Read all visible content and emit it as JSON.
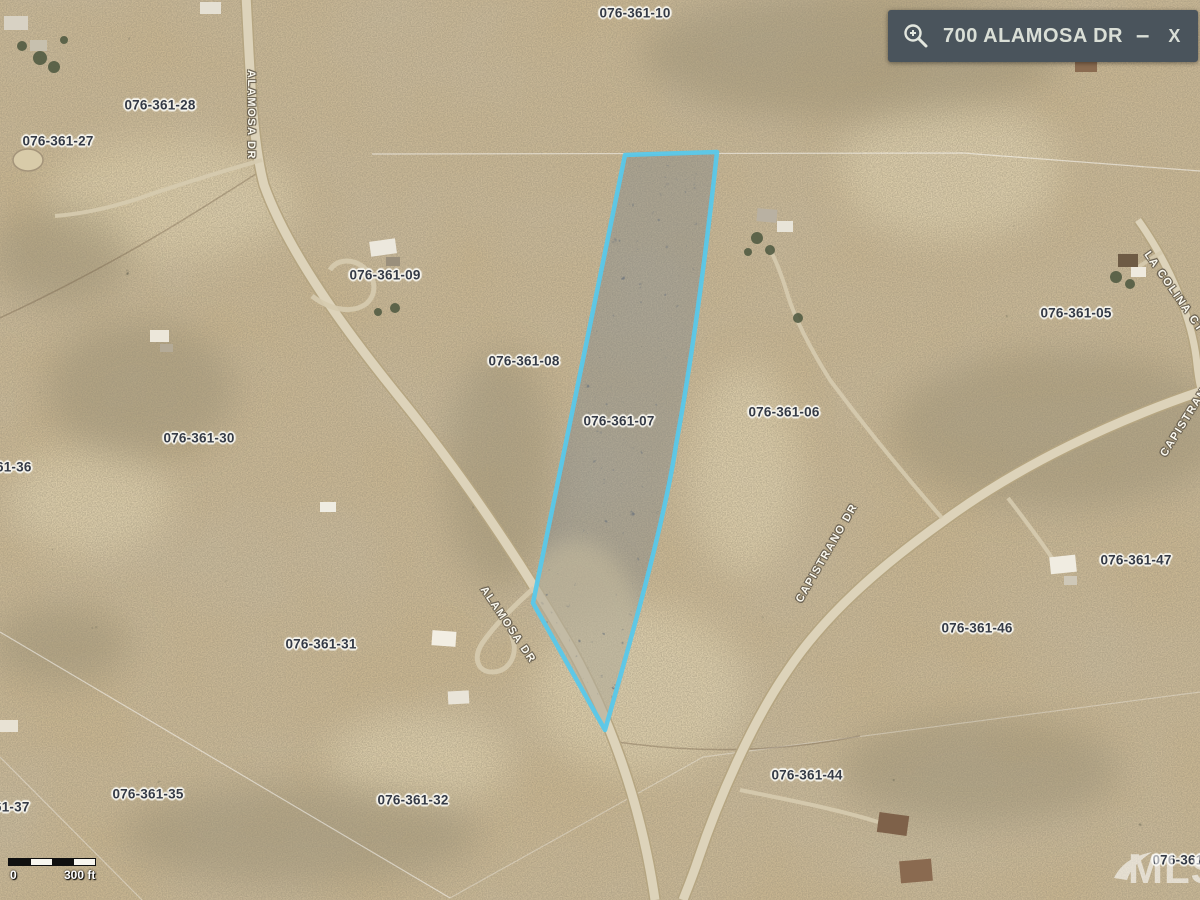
{
  "colors": {
    "highlight_stroke": "#58c8ea",
    "highlight_fill": "#6f7d8a",
    "panel_bg": "#4a545c",
    "panel_text": "#dadfd7",
    "terrain_base": "#c9b691",
    "parcel_label_text": "#343a46",
    "street_label_text": "#fbf9f0"
  },
  "search_panel": {
    "query": "700 ALAMOSA DR",
    "minimize_label": "–",
    "close_label": "X",
    "icon": "zoom-in-icon"
  },
  "map": {
    "highlighted_parcel": "076-361-07",
    "parcel_labels": [
      {
        "text": "076-361-10",
        "x": 635,
        "y": 13
      },
      {
        "text": "076-361-28",
        "x": 160,
        "y": 105
      },
      {
        "text": "076-361-27",
        "x": 58,
        "y": 141
      },
      {
        "text": "076-361-09",
        "x": 385,
        "y": 275
      },
      {
        "text": "076-361-08",
        "x": 524,
        "y": 361
      },
      {
        "text": "076-361-07",
        "x": 619,
        "y": 421
      },
      {
        "text": "076-361-06",
        "x": 784,
        "y": 412
      },
      {
        "text": "076-361-05",
        "x": 1076,
        "y": 313
      },
      {
        "text": "076-361-30",
        "x": 199,
        "y": 438
      },
      {
        "text": "076-361-36",
        "x": -4,
        "y": 467
      },
      {
        "text": "076-361-47",
        "x": 1136,
        "y": 560
      },
      {
        "text": "076-361-31",
        "x": 321,
        "y": 644
      },
      {
        "text": "076-361-46",
        "x": 977,
        "y": 628
      },
      {
        "text": "076-361-44",
        "x": 807,
        "y": 775
      },
      {
        "text": "076-361-35",
        "x": 148,
        "y": 794
      },
      {
        "text": "076-361-32",
        "x": 413,
        "y": 800
      },
      {
        "text": "076-361-37",
        "x": -6,
        "y": 807
      },
      {
        "text": "076-361-45",
        "x": 1188,
        "y": 860
      }
    ],
    "street_labels": [
      {
        "text": "ALAMOSA DR",
        "x": 251,
        "y": 115,
        "angle": 90
      },
      {
        "text": "ALAMOSA DR",
        "x": 508,
        "y": 625,
        "angle": 56
      },
      {
        "text": "CAPISTRANO DR",
        "x": 827,
        "y": 553,
        "angle": -60
      },
      {
        "text": "CAPISTRANO DR",
        "x": 1193,
        "y": 408,
        "angle": -58
      },
      {
        "text": "LA COLINA CT",
        "x": 1174,
        "y": 292,
        "angle": 55
      }
    ]
  },
  "scale_bar": {
    "start_label": "0",
    "end_label": "300 ft"
  },
  "watermark": "MLS"
}
